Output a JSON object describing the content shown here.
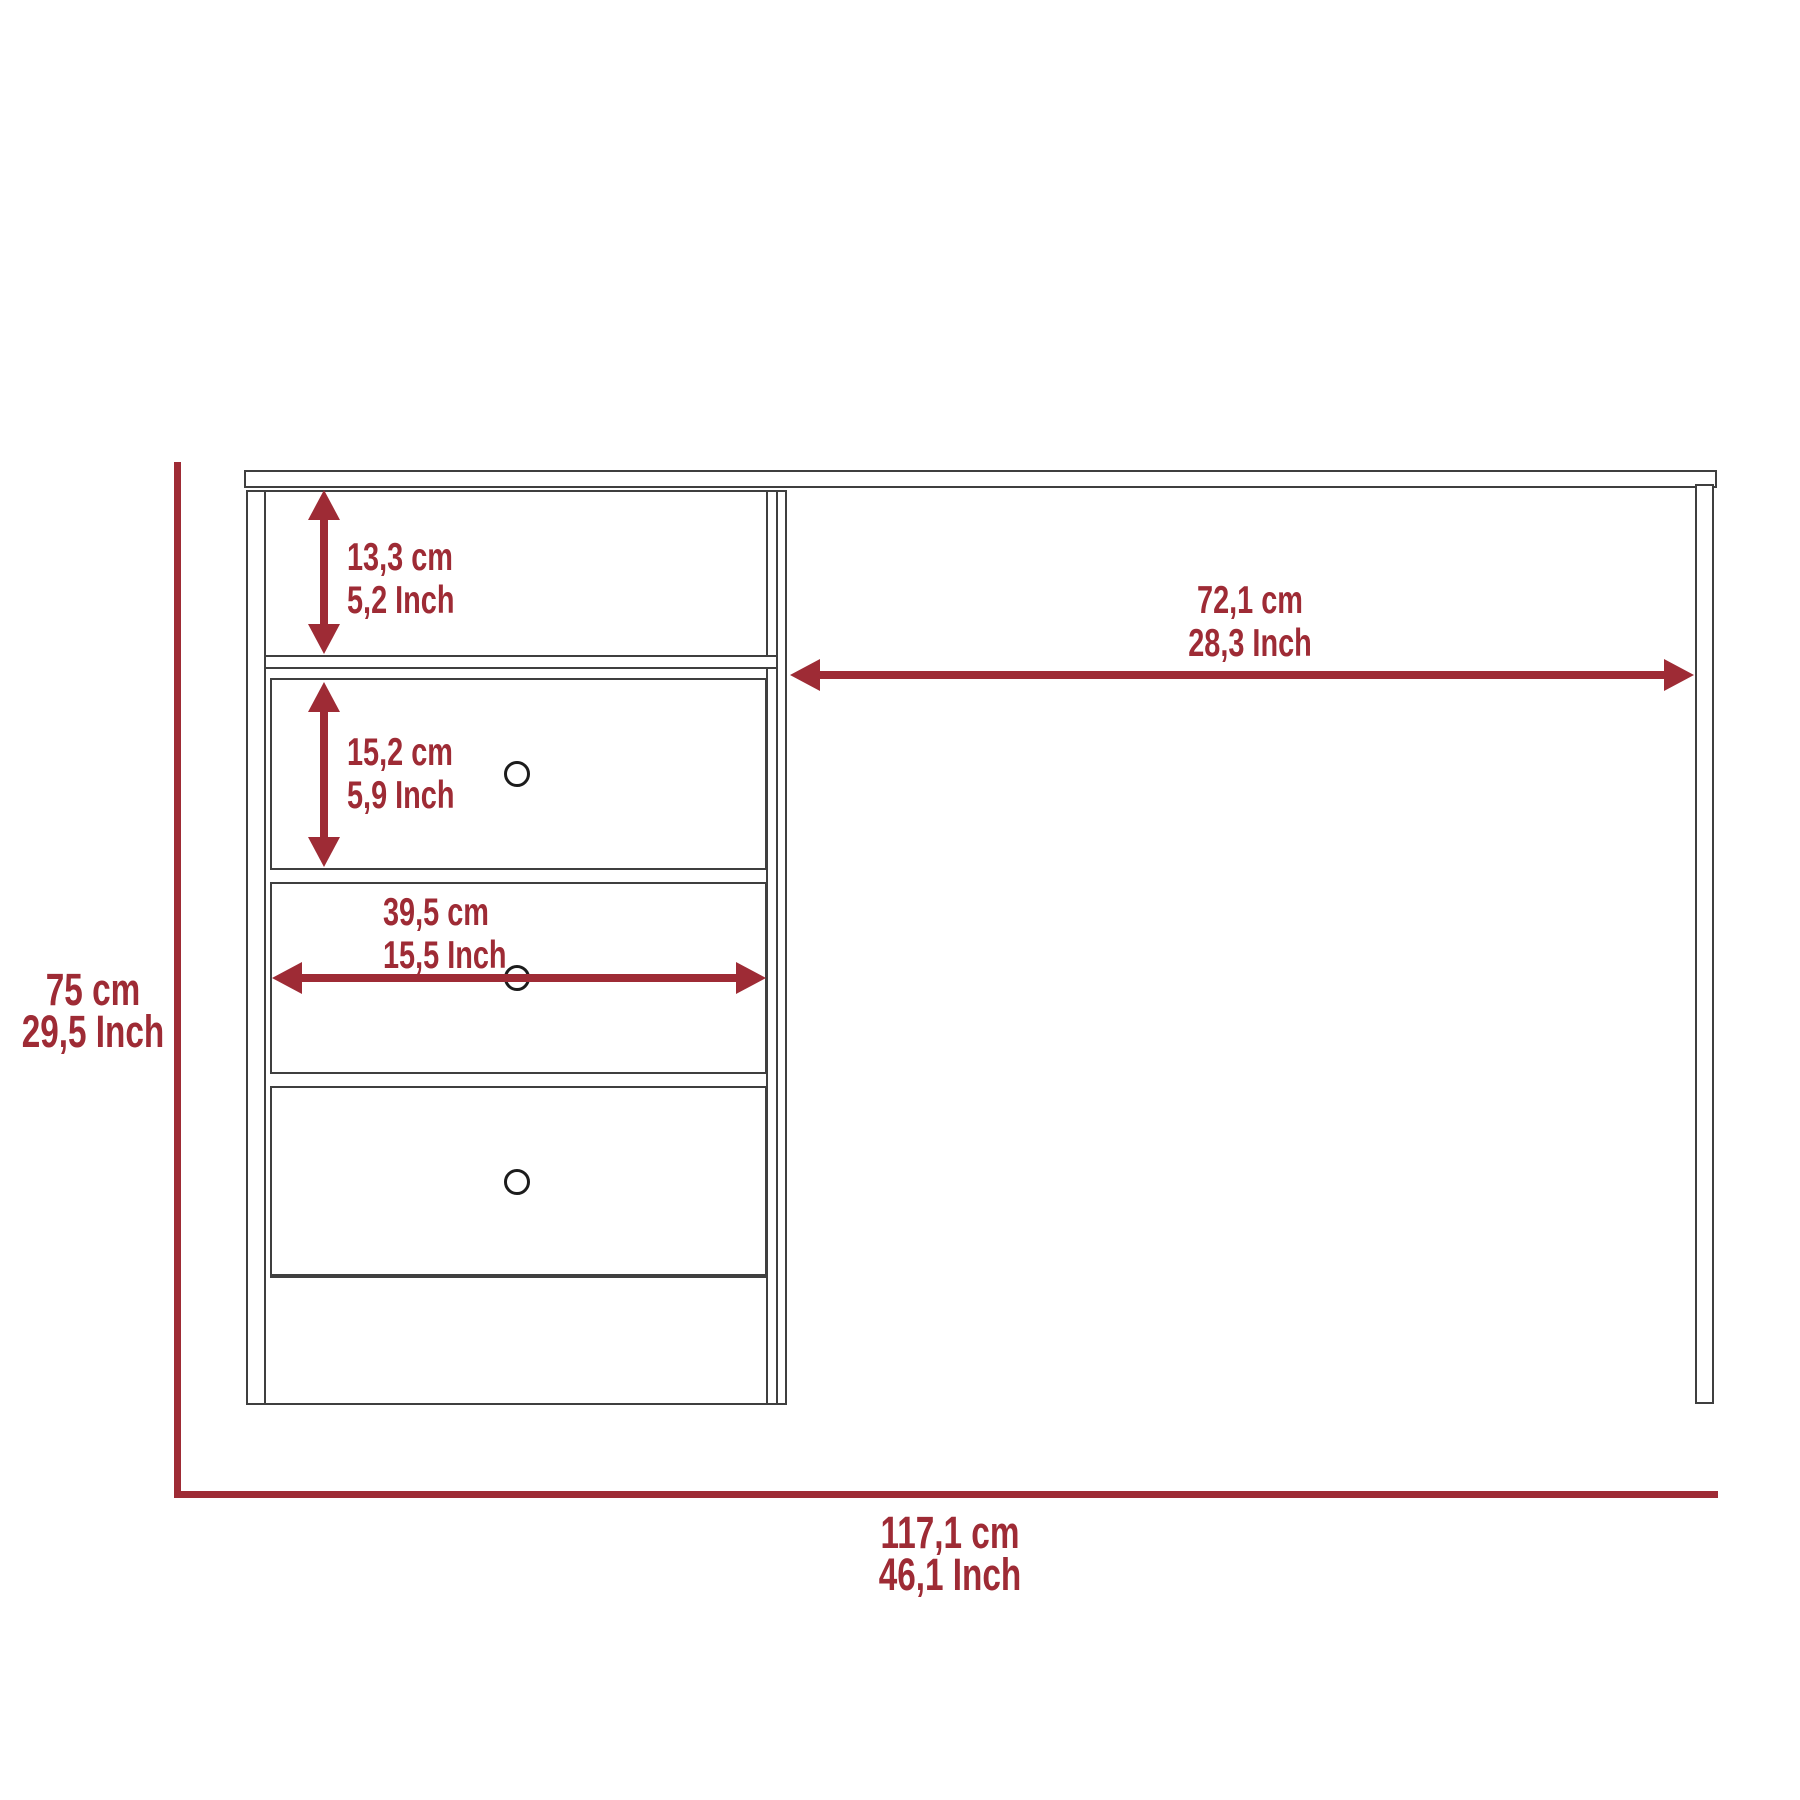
{
  "diagram_title": "desk-dimensions-diagram",
  "colors": {
    "accent": "#9E2B35",
    "line": "#3F3F3F",
    "knob": "#1C1C1C",
    "background": "#FFFFFF"
  },
  "dimensions": {
    "shelf_height": {
      "cm": "13,3 cm",
      "inch": "5,2 Inch"
    },
    "drawer_height": {
      "cm": "15,2 cm",
      "inch": "5,9 Inch"
    },
    "drawer_width": {
      "cm": "39,5 cm",
      "inch": "15,5 Inch"
    },
    "knee_space_width": {
      "cm": "72,1 cm",
      "inch": "28,3 Inch"
    },
    "overall_height": {
      "cm": "75 cm",
      "inch": "29,5 Inch"
    },
    "overall_width": {
      "cm": "117,1 cm",
      "inch": "46,1 Inch"
    }
  }
}
